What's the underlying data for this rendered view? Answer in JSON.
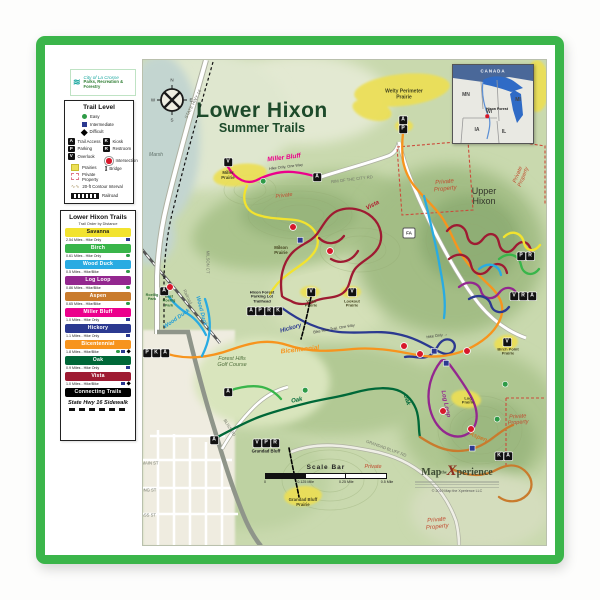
{
  "logo_box": {
    "line1": "City of La Crosse",
    "line2": "Parks, Recreation & Forestry"
  },
  "trail_level_legend": {
    "title": "Trail Level",
    "levels": [
      {
        "label": "Easy",
        "shape": "circle",
        "color": "#2e9b47"
      },
      {
        "label": "Intermediate",
        "shape": "square",
        "color": "#2b3990"
      },
      {
        "label": "Difficult",
        "shape": "diamond",
        "color": "#000000"
      }
    ],
    "symbols_left": [
      {
        "letter": "A",
        "label": "Trail Access"
      },
      {
        "letter": "P",
        "label": "Parking"
      },
      {
        "letter": "V",
        "label": "Overlook"
      }
    ],
    "symbols_right": [
      {
        "letter": "K",
        "label": "Kiosk"
      },
      {
        "letter": "R",
        "label": "Restroom"
      }
    ],
    "intersection_label": "Intersection",
    "bridge_label": "Bridge",
    "prairies_label": "Prairies",
    "private_label": "Private Property",
    "contour_label": "20-ft Contour Interval",
    "railroad_label": "Railroad"
  },
  "trails_legend": {
    "title": "Lower Hixon Trails",
    "subtitle": "Trail Order by Distance",
    "trails": [
      {
        "key": "savanna",
        "name": "Savanna",
        "color": "#f2e32f",
        "text": "#1a1a1a",
        "detail": "2.54 Miles - Hike Only",
        "levels": [
          "square"
        ]
      },
      {
        "key": "birch",
        "name": "Birch",
        "color": "#39b54a",
        "text": "#ffffff",
        "detail": "0.61 Miles - Hike Only",
        "levels": [
          "circle"
        ]
      },
      {
        "key": "wood_duck",
        "name": "Wood Duck",
        "color": "#29abe2",
        "text": "#ffffff",
        "detail": "0.5 Miles - Hike/Bike",
        "levels": [
          "circle"
        ]
      },
      {
        "key": "log_loop",
        "name": "Log Loop",
        "color": "#93278f",
        "text": "#ffffff",
        "detail": "0.86 Miles - Hike/Bike",
        "levels": [
          "circle"
        ]
      },
      {
        "key": "aspen",
        "name": "Aspen",
        "color": "#c97b2d",
        "text": "#ffffff",
        "detail": "0.65 Miles - Hike/Bike",
        "levels": [
          "circle"
        ]
      },
      {
        "key": "miller_bluff",
        "name": "Miller Bluff",
        "color": "#ec008c",
        "text": "#ffffff",
        "detail": "1.0 Miles - Hike Only",
        "levels": [
          "square"
        ]
      },
      {
        "key": "hickory",
        "name": "Hickory",
        "color": "#2b3990",
        "text": "#ffffff",
        "detail": "1.1 Miles - Hike Only",
        "levels": [
          "square"
        ]
      },
      {
        "key": "bicentennial",
        "name": "Bicentennial",
        "color": "#f7941d",
        "text": "#ffffff",
        "detail": "1.8 Miles - Hike/Bike",
        "levels": [
          "circle",
          "square",
          "diamond"
        ]
      },
      {
        "key": "oak",
        "name": "Oak",
        "color": "#006838",
        "text": "#ffffff",
        "detail": "0.9 Miles - Hike Only",
        "levels": [
          "square"
        ]
      },
      {
        "key": "vista",
        "name": "Vista",
        "color": "#9e1b32",
        "text": "#ffffff",
        "detail": "1.0 Miles - Hike/Bike",
        "levels": [
          "square",
          "diamond"
        ]
      }
    ],
    "connecting": {
      "key": "connecting",
      "name": "Connecting Trails",
      "color": "#000000",
      "text": "#ffffff"
    },
    "sidewalk_label": "State Hwy 16 Sidewalk"
  },
  "map": {
    "title": "Lower Hixon",
    "subtitle": "Summer Trails",
    "road_shield": {
      "text": "FA",
      "x": 409,
      "y": 233
    },
    "scale_bar": {
      "label": "Scale Bar",
      "ticks": [
        "0",
        "0.125 Mile",
        "0.25 Mile",
        "0.5 Mile"
      ]
    },
    "credit": {
      "brand_left": "Map",
      "brand_mid": "the",
      "brand_x": "X",
      "brand_right": "perience",
      "copyright": "© 2019 Map the Xperience LLC"
    },
    "inset": {
      "country": "CANADA",
      "states": [
        "MN",
        "WI",
        "MI",
        "IA",
        "IL"
      ],
      "marker": "Hixon Forest"
    },
    "labels": [
      {
        "text": "STATE HWY 16",
        "x": 193,
        "y": 104,
        "s": 4.5,
        "c": "#73786a",
        "r": -63
      },
      {
        "text": "N",
        "x": 172,
        "y": 80,
        "s": 4.5,
        "c": "#333333"
      },
      {
        "text": "E",
        "x": 191,
        "y": 100,
        "s": 4.5,
        "c": "#333333"
      },
      {
        "text": "S",
        "x": 172,
        "y": 120,
        "s": 4.5,
        "c": "#333333"
      },
      {
        "text": "W",
        "x": 153,
        "y": 100,
        "s": 4.5,
        "c": "#333333"
      },
      {
        "text": "Marsh",
        "x": 156,
        "y": 156,
        "s": 5,
        "c": "#5f7069",
        "i": true
      },
      {
        "text": "Welty Perimeter\nPrairie",
        "x": 404,
        "y": 95,
        "s": 5,
        "c": "#44441f",
        "w": true
      },
      {
        "text": "Miller Bluff",
        "x": 284,
        "y": 158,
        "s": 6.5,
        "c": "#ec008c",
        "r": -7,
        "w": true,
        "i": true
      },
      {
        "text": "Hike Only, One Way",
        "x": 286,
        "y": 167,
        "s": 3.8,
        "c": "#3a3a3a",
        "r": -7
      },
      {
        "text": "Miller\nPrairie",
        "x": 228,
        "y": 176,
        "s": 4.3,
        "c": "#44441f",
        "w": true
      },
      {
        "text": "RIM OF THE CITY RD",
        "x": 352,
        "y": 180,
        "s": 4.2,
        "c": "#73786a",
        "r": -7
      },
      {
        "text": "Private",
        "x": 284,
        "y": 196,
        "s": 5.5,
        "c": "#c14a2e",
        "r": -8,
        "i": true
      },
      {
        "text": "Private\nProperty",
        "x": 445,
        "y": 186,
        "s": 6,
        "c": "#c14a2e",
        "r": -6,
        "i": true
      },
      {
        "text": "Private\nProperty",
        "x": 521,
        "y": 176,
        "s": 5.5,
        "c": "#c14a2e",
        "r": -68,
        "i": true
      },
      {
        "text": "Upper\nHixon",
        "x": 484,
        "y": 196,
        "s": 9,
        "c": "#33352b"
      },
      {
        "text": "Vista",
        "x": 373,
        "y": 206,
        "s": 6,
        "c": "#b01c2e",
        "r": -28,
        "w": true,
        "i": true
      },
      {
        "text": "Milson\nPrairie",
        "x": 281,
        "y": 251,
        "s": 4.3,
        "c": "#44441f",
        "w": true
      },
      {
        "text": "MILSON CT",
        "x": 207,
        "y": 262,
        "s": 4.2,
        "c": "#73786a",
        "r": 90
      },
      {
        "text": "Railroad",
        "x": 187,
        "y": 297,
        "s": 4.2,
        "c": "#73786a",
        "r": 65
      },
      {
        "text": "Roellig\nPark",
        "x": 152,
        "y": 297,
        "s": 3.8,
        "c": "#2e6b30",
        "w": true
      },
      {
        "text": "East\nRoellig\nPark",
        "x": 169,
        "y": 301,
        "s": 3.8,
        "c": "#2e6b30",
        "w": true
      },
      {
        "text": "Wood Duck",
        "x": 177,
        "y": 319,
        "s": 5.5,
        "c": "#1e9cd8",
        "r": -35,
        "w": true,
        "i": true
      },
      {
        "text": "Wood Duck",
        "x": 201,
        "y": 311,
        "s": 5.5,
        "c": "#1e9cd8",
        "r": 75,
        "w": true,
        "i": true
      },
      {
        "text": "Hixon Forest\nParking Lot\nTrailhead",
        "x": 262,
        "y": 297,
        "s": 4,
        "c": "#222222",
        "w": true
      },
      {
        "text": "Vista\nPrairie",
        "x": 311,
        "y": 304,
        "s": 4,
        "c": "#44441f",
        "w": true
      },
      {
        "text": "Lookout\nPrairie",
        "x": 352,
        "y": 304,
        "s": 4,
        "c": "#44441f",
        "w": true
      },
      {
        "text": "Hickory",
        "x": 291,
        "y": 329,
        "s": 6,
        "c": "#2b3990",
        "r": -16,
        "w": true,
        "i": true
      },
      {
        "text": "Bike Hike Trail, One Way",
        "x": 334,
        "y": 329,
        "s": 3.8,
        "c": "#3a3a3a",
        "r": -10
      },
      {
        "text": "Bicentennial",
        "x": 300,
        "y": 350,
        "s": 6.5,
        "c": "#f7941d",
        "r": -6,
        "w": true,
        "i": true
      },
      {
        "text": "Forest Hills\nGolf Course",
        "x": 232,
        "y": 362,
        "s": 5.5,
        "c": "#4f6f3c",
        "i": true
      },
      {
        "text": "Hike Only →",
        "x": 437,
        "y": 336,
        "s": 3.8,
        "c": "#3a3a3a",
        "r": -8
      },
      {
        "text": "Oak",
        "x": 297,
        "y": 401,
        "s": 6,
        "c": "#006838",
        "r": -12,
        "w": true,
        "i": true
      },
      {
        "text": "Oak",
        "x": 406,
        "y": 400,
        "s": 6,
        "c": "#006838",
        "r": 72,
        "w": true,
        "i": true
      },
      {
        "text": "Log Loop",
        "x": 445,
        "y": 404,
        "s": 6,
        "c": "#93278f",
        "r": 78,
        "w": true,
        "i": true
      },
      {
        "text": "Log\nPrairie",
        "x": 468,
        "y": 401,
        "s": 4,
        "c": "#44441f",
        "w": true
      },
      {
        "text": "Aspen",
        "x": 478,
        "y": 438,
        "s": 6,
        "c": "#c97b2d",
        "r": 22,
        "w": true,
        "i": true
      },
      {
        "text": "Birch Point\nPrairie",
        "x": 508,
        "y": 352,
        "s": 4,
        "c": "#44441f",
        "w": true
      },
      {
        "text": "Private\nProperty",
        "x": 518,
        "y": 420,
        "s": 5.5,
        "c": "#c14a2e",
        "r": -4,
        "i": true
      },
      {
        "text": "BLISS RD",
        "x": 229,
        "y": 428,
        "s": 4.2,
        "c": "#73786a",
        "r": 58
      },
      {
        "text": "GRANDAD BLUFF RD",
        "x": 386,
        "y": 449,
        "s": 4.2,
        "c": "#73786a",
        "r": 20
      },
      {
        "text": "Grandad Bluff",
        "x": 266,
        "y": 452,
        "s": 4.3,
        "c": "#222222",
        "w": true
      },
      {
        "text": "Grandad Bluff\nPrairie",
        "x": 303,
        "y": 503,
        "s": 4.3,
        "c": "#44441f",
        "w": true
      },
      {
        "text": "Private",
        "x": 373,
        "y": 467,
        "s": 5.5,
        "c": "#c14a2e",
        "i": true
      },
      {
        "text": "Private\nProperty",
        "x": 437,
        "y": 524,
        "s": 6,
        "c": "#c14a2e",
        "r": -6,
        "i": true
      },
      {
        "text": "MAIN ST",
        "x": 150,
        "y": 464,
        "s": 4.2,
        "c": "#73786a"
      },
      {
        "text": "KING ST",
        "x": 148,
        "y": 491,
        "s": 4.2,
        "c": "#73786a"
      },
      {
        "text": "CASS ST",
        "x": 147,
        "y": 516,
        "s": 4.2,
        "c": "#73786a"
      }
    ],
    "point_markers": [
      {
        "t": "A",
        "x": 403,
        "y": 120
      },
      {
        "t": "P",
        "x": 403,
        "y": 129
      },
      {
        "t": "V",
        "x": 228,
        "y": 162
      },
      {
        "t": "A",
        "x": 317,
        "y": 177
      },
      {
        "t": "A",
        "x": 164,
        "y": 291
      },
      {
        "t": "V",
        "x": 311,
        "y": 292
      },
      {
        "t": "V",
        "x": 352,
        "y": 292
      },
      {
        "t": "A",
        "x": 251,
        "y": 311
      },
      {
        "t": "P",
        "x": 260,
        "y": 311
      },
      {
        "t": "R",
        "x": 269,
        "y": 311
      },
      {
        "t": "K",
        "x": 278,
        "y": 311
      },
      {
        "t": "P",
        "x": 147,
        "y": 353
      },
      {
        "t": "K",
        "x": 156,
        "y": 353
      },
      {
        "t": "A",
        "x": 165,
        "y": 353
      },
      {
        "t": "A",
        "x": 228,
        "y": 392
      },
      {
        "t": "A",
        "x": 214,
        "y": 440
      },
      {
        "t": "P",
        "x": 521,
        "y": 256
      },
      {
        "t": "R",
        "x": 530,
        "y": 256
      },
      {
        "t": "V",
        "x": 514,
        "y": 296
      },
      {
        "t": "R",
        "x": 523,
        "y": 296
      },
      {
        "t": "A",
        "x": 532,
        "y": 296
      },
      {
        "t": "V",
        "x": 507,
        "y": 342
      },
      {
        "t": "V",
        "x": 257,
        "y": 443
      },
      {
        "t": "P",
        "x": 266,
        "y": 443
      },
      {
        "t": "R",
        "x": 275,
        "y": 443
      },
      {
        "t": "K",
        "x": 499,
        "y": 456
      },
      {
        "t": "A",
        "x": 508,
        "y": 456
      }
    ],
    "intersections": [
      {
        "x": 420,
        "y": 354
      },
      {
        "x": 467,
        "y": 351
      },
      {
        "x": 443,
        "y": 411
      },
      {
        "x": 471,
        "y": 429
      },
      {
        "x": 330,
        "y": 251
      },
      {
        "x": 293,
        "y": 227
      },
      {
        "x": 170,
        "y": 287
      },
      {
        "x": 404,
        "y": 346
      }
    ],
    "level_markers": [
      {
        "shape": "square",
        "x": 434,
        "y": 351
      },
      {
        "shape": "square",
        "x": 446,
        "y": 363
      },
      {
        "shape": "square",
        "x": 300,
        "y": 240
      },
      {
        "shape": "square",
        "x": 472,
        "y": 448
      },
      {
        "shape": "circle",
        "x": 505,
        "y": 384
      },
      {
        "shape": "circle",
        "x": 497,
        "y": 419
      },
      {
        "shape": "circle",
        "x": 305,
        "y": 390
      },
      {
        "shape": "circle",
        "x": 263,
        "y": 181
      }
    ]
  }
}
